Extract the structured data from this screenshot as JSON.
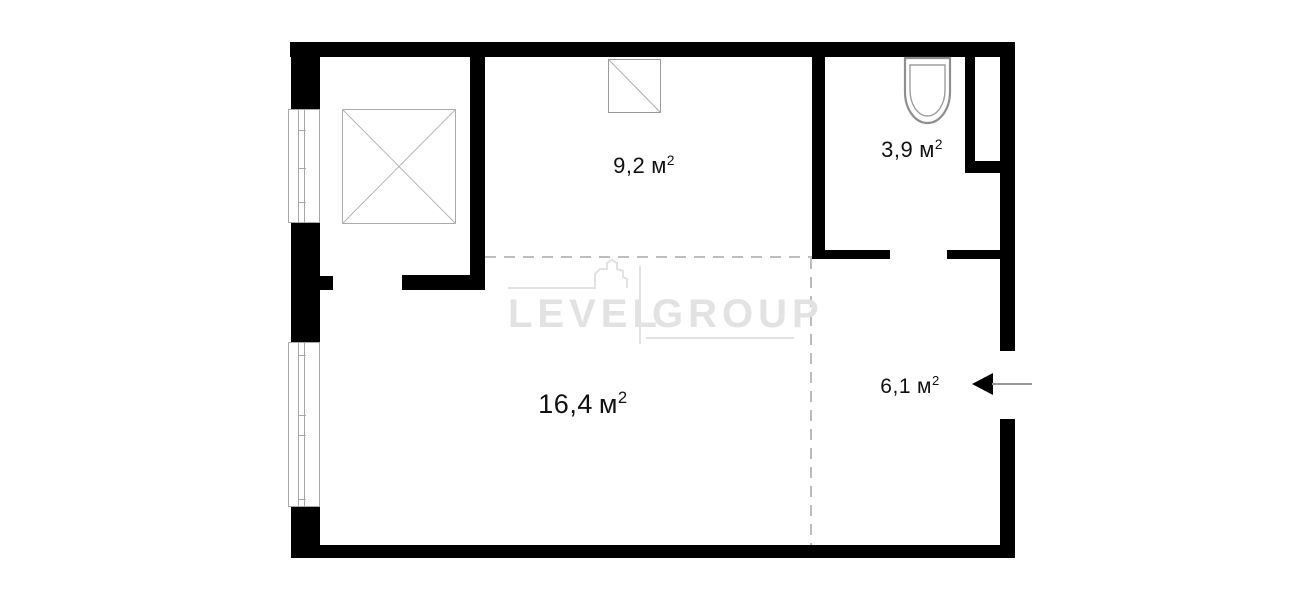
{
  "title": "apartment-floor-plan",
  "watermark": {
    "left": "LEVEL",
    "right": "GROUP"
  },
  "rooms": [
    {
      "name": "room-top-middle",
      "area_value": "9,2",
      "area_unit": "м",
      "area_sup": "2"
    },
    {
      "name": "bathroom",
      "area_value": "3,9",
      "area_unit": "м",
      "area_sup": "2"
    },
    {
      "name": "living-room",
      "area_value": "16,4",
      "area_unit": "м",
      "area_sup": "2"
    },
    {
      "name": "hallway",
      "area_value": "6,1",
      "area_unit": "м",
      "area_sup": "2"
    }
  ],
  "icons": [
    "crossed-shaft-icon",
    "vent-shaft-icon",
    "toilet-icon",
    "entrance-arrow-icon",
    "window-symbol"
  ],
  "colors": {
    "wall": "#000000",
    "fixture_outline": "#a0a0a0",
    "dashed_line": "#bdbdbd",
    "watermark": "#e2e2e2",
    "label_text": "#111111"
  }
}
